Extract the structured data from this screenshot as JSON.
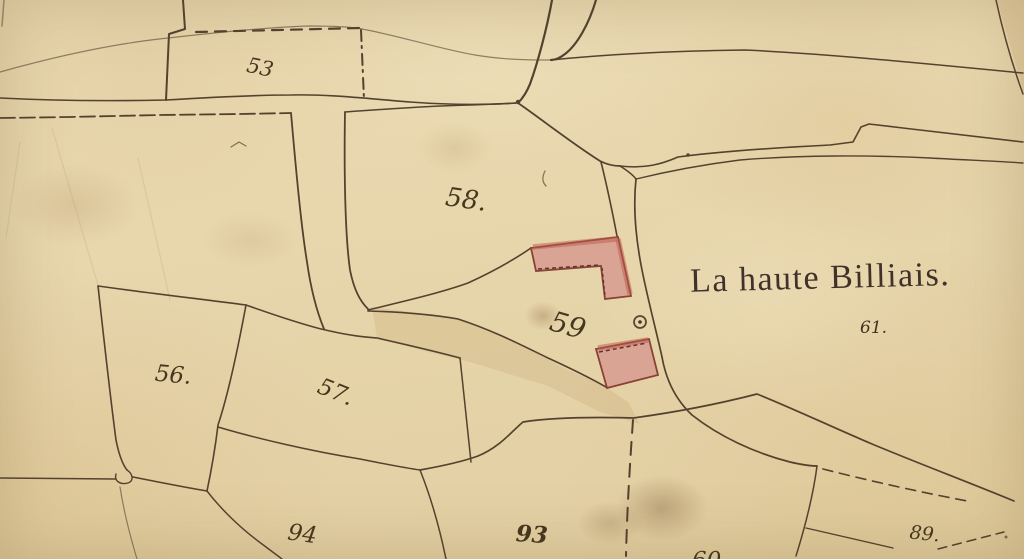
{
  "map": {
    "placename": "La haute Billiais.",
    "parcel_labels": {
      "p53": "53",
      "p56": "56.",
      "p57": "57.",
      "p58": "58.",
      "p59": "59",
      "p60": "60",
      "p61": "61.",
      "p89": "89.",
      "p93": "93",
      "p94": "94"
    },
    "colors": {
      "paper": "#e8d7ae",
      "ink": "#54422e",
      "building_fill": "#d9a093",
      "building_outline": "#8a4136",
      "placename_ink": "#40312a"
    }
  }
}
